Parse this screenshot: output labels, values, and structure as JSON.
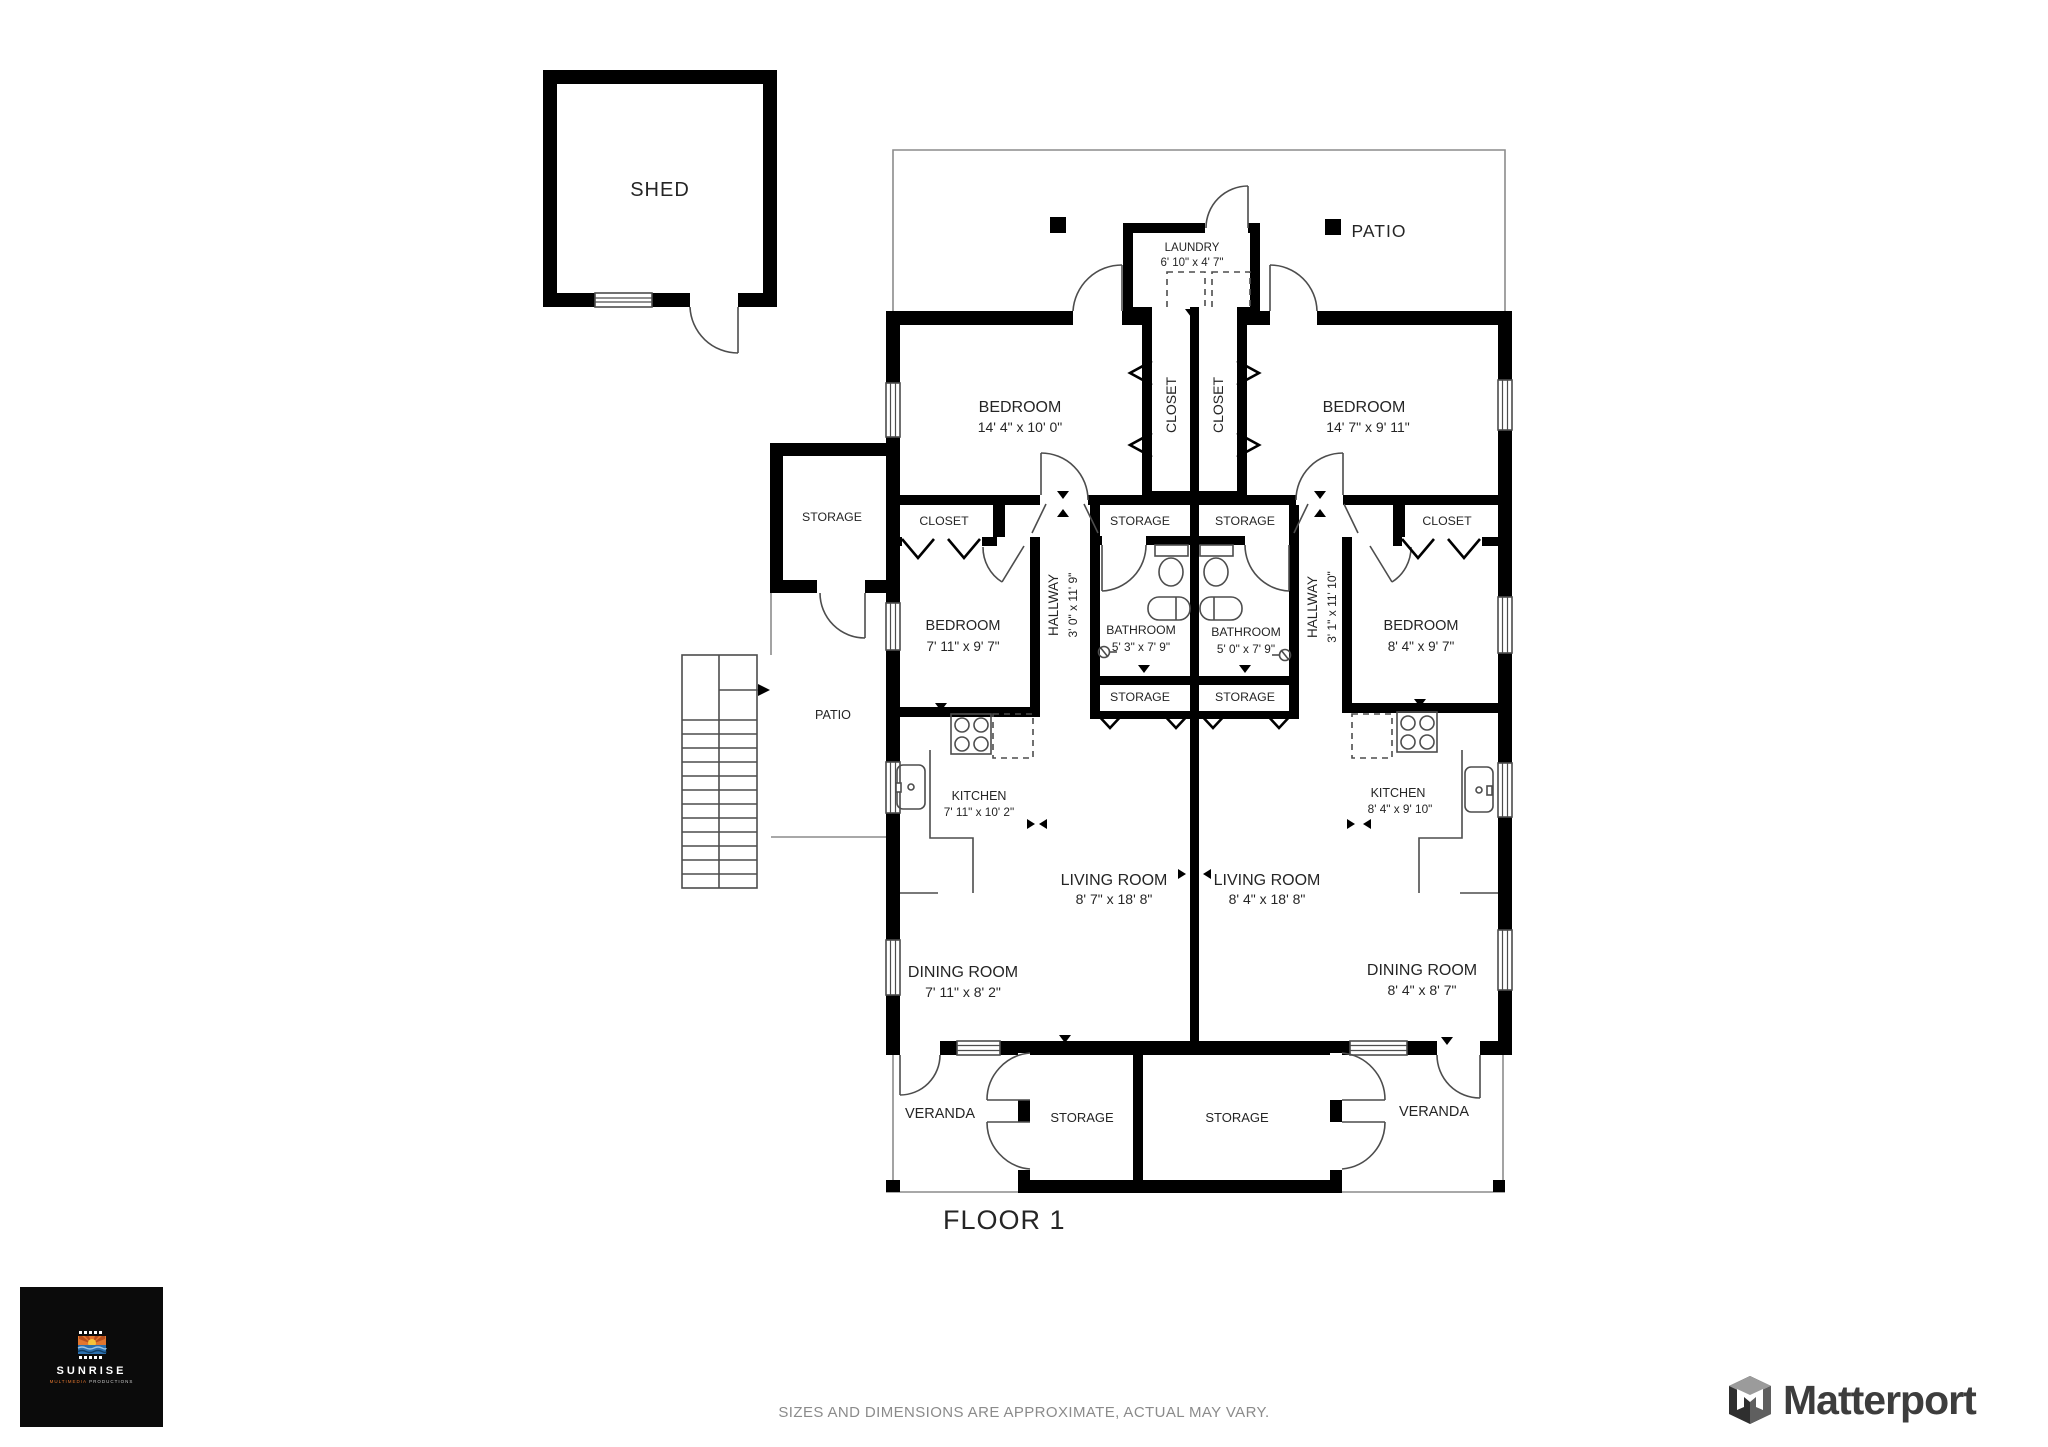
{
  "plan": {
    "floor_label": "FLOOR 1",
    "shed": {
      "label": "SHED"
    },
    "top_patio": {
      "label": "PATIO"
    },
    "annex": {
      "storage": "STORAGE",
      "patio": "PATIO"
    },
    "laundry": {
      "name": "LAUNDRY",
      "dims": "6' 10\" x 4' 7\""
    },
    "unit_left": {
      "bedroom1": {
        "name": "BEDROOM",
        "dims": "14' 4\" x 10' 0\""
      },
      "closet_strip": "CLOSET",
      "closet": "CLOSET",
      "storage_upper": "STORAGE",
      "hallway": {
        "name": "HALLWAY",
        "dims": "3' 0\" x 11' 9\""
      },
      "bathroom": {
        "name": "BATHROOM",
        "dims": "5' 3\" x 7' 9\""
      },
      "storage_lower": "STORAGE",
      "bedroom2": {
        "name": "BEDROOM",
        "dims": "7' 11\" x 9' 7\""
      },
      "kitchen": {
        "name": "KITCHEN",
        "dims": "7' 11\" x 10' 2\""
      },
      "living": {
        "name": "LIVING ROOM",
        "dims": "8' 7\" x 18' 8\""
      },
      "dining": {
        "name": "DINING ROOM",
        "dims": "7' 11\" x 8' 2\""
      },
      "veranda": "VERANDA",
      "storage_bottom": "STORAGE"
    },
    "unit_right": {
      "bedroom1": {
        "name": "BEDROOM",
        "dims": "14' 7\" x 9' 11\""
      },
      "closet_strip": "CLOSET",
      "closet": "CLOSET",
      "storage_upper": "STORAGE",
      "hallway": {
        "name": "HALLWAY",
        "dims": "3' 1\" x 11' 10\""
      },
      "bathroom": {
        "name": "BATHROOM",
        "dims": "5' 0\" x 7' 9\""
      },
      "storage_lower": "STORAGE",
      "bedroom2": {
        "name": "BEDROOM",
        "dims": "8' 4\" x 9' 7\""
      },
      "kitchen": {
        "name": "KITCHEN",
        "dims": "8' 4\" x 9' 10\""
      },
      "living": {
        "name": "LIVING ROOM",
        "dims": "8' 4\" x 18' 8\""
      },
      "dining": {
        "name": "DINING ROOM",
        "dims": "8' 4\" x 8' 7\""
      },
      "veranda": "VERANDA",
      "storage_bottom": "STORAGE"
    }
  },
  "footer": {
    "disclaimer": "SIZES AND DIMENSIONS ARE APPROXIMATE, ACTUAL MAY VARY."
  },
  "branding": {
    "sunrise": {
      "title": "SUNRISE",
      "subtitle_accent": "MULTIMEDIA",
      "subtitle_rest": "PRODUCTIONS"
    },
    "matterport": {
      "label": "Matterport"
    }
  },
  "colors": {
    "wall": "#000000",
    "plan_text": "#252525",
    "muted_text": "#8b8b8b",
    "sunrise_orange": "#e2762f",
    "sunrise_blue": "#2b6fae",
    "matterport_gray": "#3d3d3d"
  }
}
